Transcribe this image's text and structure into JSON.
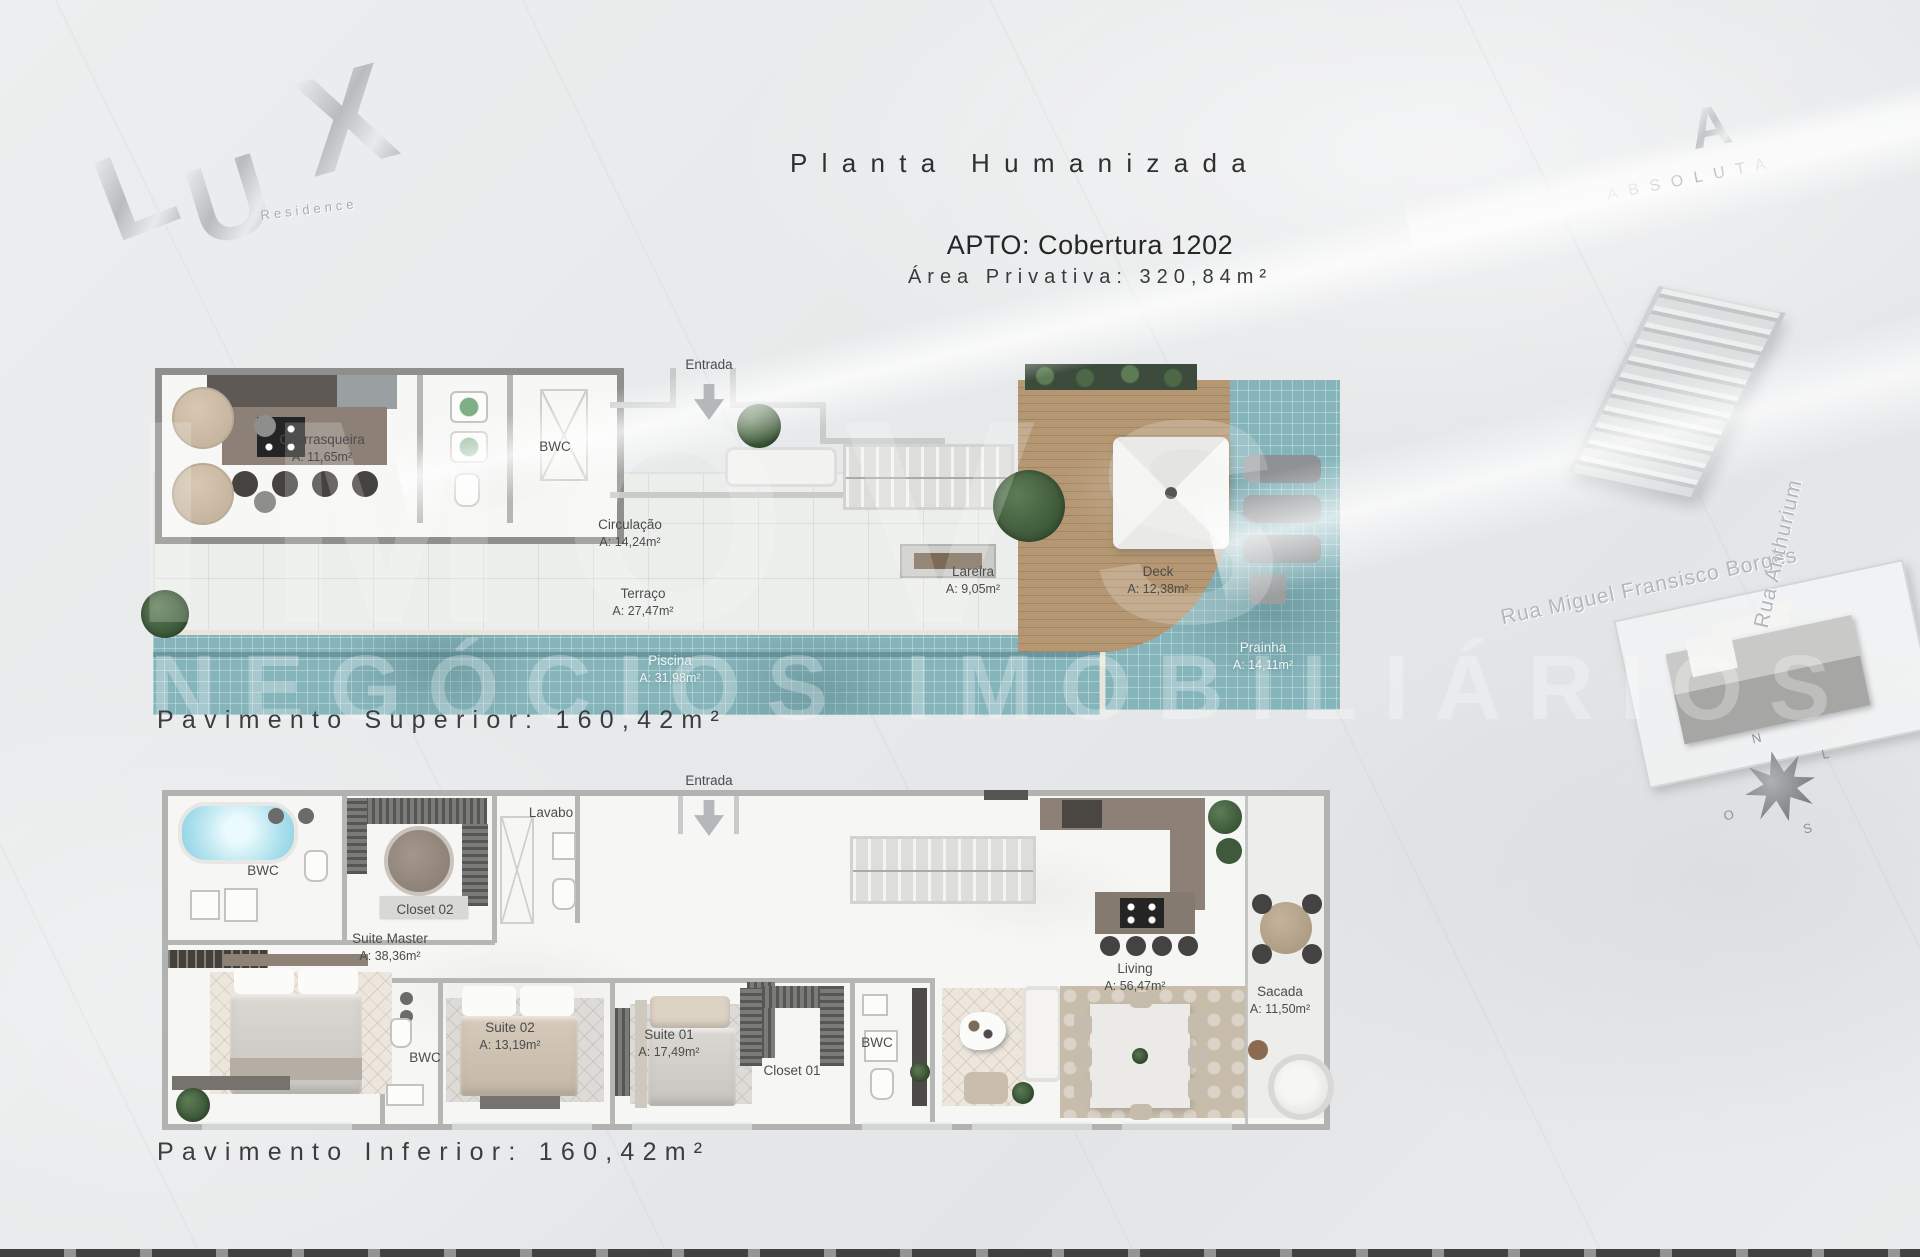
{
  "header": {
    "title": "Planta Humanizada",
    "apartment": "APTO: Cobertura 1202",
    "private_area": "Área Privativa: 320,84m²"
  },
  "branding": {
    "lux": {
      "l": "L",
      "u": "U",
      "x": "X",
      "tagline": "Residence"
    },
    "absoluta": {
      "monogram": "A",
      "name": "ABSOLUTA"
    }
  },
  "watermark": {
    "line1": "IMOVS",
    "line2": "NEGÓCIOS IMOBILIÁRIOS"
  },
  "upper_floor": {
    "caption": "Pavimento Superior: 160,42m²",
    "entrance": "Entrada",
    "churrasqueira": {
      "name": "Churrasqueira",
      "area": "A: 11,65m²"
    },
    "bwc": {
      "name": "BWC"
    },
    "circulacao": {
      "name": "Circulação",
      "area": "A: 14,24m²"
    },
    "terraco": {
      "name": "Terraço",
      "area": "A: 27,47m²"
    },
    "lareira": {
      "name": "Lareira",
      "area": "A: 9,05m²"
    },
    "deck": {
      "name": "Deck",
      "area": "A: 12,38m²"
    },
    "piscina": {
      "name": "Piscina",
      "area": "A: 31,98m²"
    },
    "prainha": {
      "name": "Prainha",
      "area": "A: 14,11m²"
    }
  },
  "lower_floor": {
    "caption": "Pavimento Inferior: 160,42m²",
    "entrance": "Entrada",
    "bwc_master": {
      "name": "BWC"
    },
    "closet02": {
      "name": "Closet 02"
    },
    "lavabo": {
      "name": "Lavabo"
    },
    "suite_master": {
      "name": "Suite Master",
      "area": "A: 38,36m²"
    },
    "suite02": {
      "name": "Suite 02",
      "area": "A: 13,19m²"
    },
    "bwc_suite02": {
      "name": "BWC"
    },
    "suite01": {
      "name": "Suite 01",
      "area": "A: 17,49m²"
    },
    "closet01": {
      "name": "Closet 01"
    },
    "bwc_suite01": {
      "name": "BWC"
    },
    "living": {
      "name": "Living",
      "area": "A: 56,47m²"
    },
    "sacada": {
      "name": "Sacada",
      "area": "A: 11,50m²"
    }
  },
  "site": {
    "street_1": "Rua Miguel Fransisco Borges",
    "street_2": "Rua Anthurium",
    "compass": {
      "n": "N",
      "s": "S",
      "l": "L",
      "o": "O"
    }
  },
  "colors": {
    "pool": "#85b5bb",
    "deck_wood": "#b59873",
    "wall_gray": "#8f8f8d",
    "label_text": "#4c4c4c",
    "background": "#e8eaeb"
  }
}
